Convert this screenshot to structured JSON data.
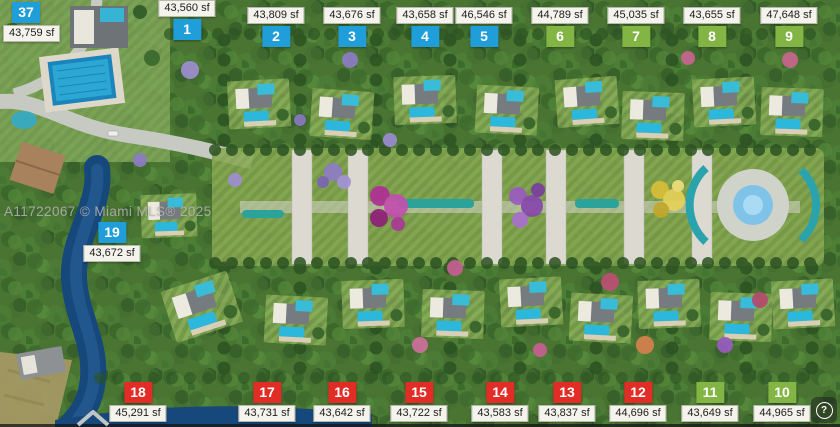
{
  "image": {
    "watermark": "A11722067 © Miami MLS® 2025",
    "help_icon_glyph": "?"
  },
  "badge_colors": {
    "blue": "#1f9ed9",
    "green": "#82b544",
    "red": "#e22d26"
  },
  "lots": [
    {
      "number": "37",
      "area": "43,759 sf",
      "badge_color": "blue"
    },
    {
      "number": "1",
      "area": "43,560 sf",
      "badge_color": "blue"
    },
    {
      "number": "2",
      "area": "43,809 sf",
      "badge_color": "blue"
    },
    {
      "number": "3",
      "area": "43,676 sf",
      "badge_color": "blue"
    },
    {
      "number": "4",
      "area": "43,658 sf",
      "badge_color": "blue"
    },
    {
      "number": "5",
      "area": "46,546 sf",
      "badge_color": "blue"
    },
    {
      "number": "6",
      "area": "44,789 sf",
      "badge_color": "green"
    },
    {
      "number": "7",
      "area": "45,035 sf",
      "badge_color": "green"
    },
    {
      "number": "8",
      "area": "43,655 sf",
      "badge_color": "green"
    },
    {
      "number": "9",
      "area": "47,648 sf",
      "badge_color": "green"
    },
    {
      "number": "19",
      "area": "43,672 sf",
      "badge_color": "blue"
    },
    {
      "number": "18",
      "area": "45,291 sf",
      "badge_color": "red"
    },
    {
      "number": "17",
      "area": "43,731 sf",
      "badge_color": "red"
    },
    {
      "number": "16",
      "area": "43,642 sf",
      "badge_color": "red"
    },
    {
      "number": "15",
      "area": "43,722 sf",
      "badge_color": "red"
    },
    {
      "number": "14",
      "area": "43,583 sf",
      "badge_color": "red"
    },
    {
      "number": "13",
      "area": "43,837 sf",
      "badge_color": "red"
    },
    {
      "number": "12",
      "area": "44,696 sf",
      "badge_color": "red"
    },
    {
      "number": "11",
      "area": "43,649 sf",
      "badge_color": "green"
    },
    {
      "number": "10",
      "area": "44,965 sf",
      "badge_color": "green"
    }
  ]
}
